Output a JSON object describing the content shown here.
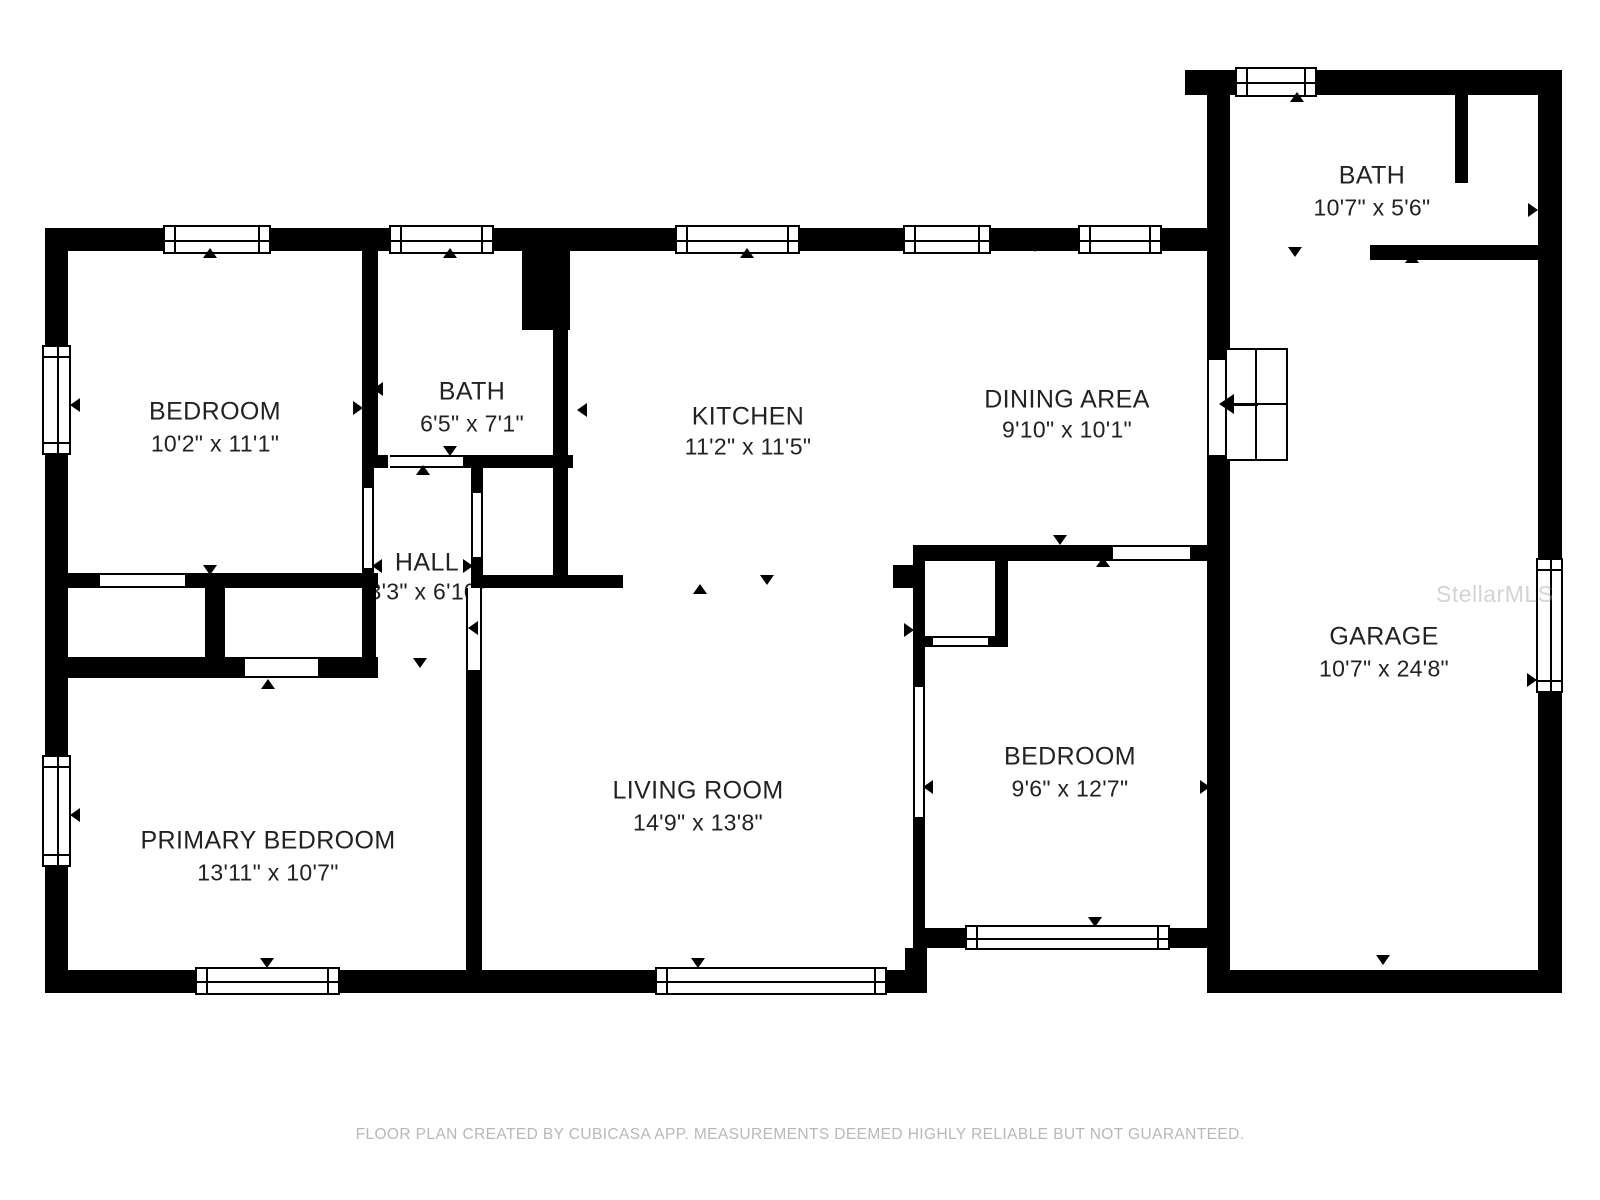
{
  "footer": {
    "disclaimer": "FLOOR PLAN CREATED BY CUBICASA APP. MEASUREMENTS DEEMED HIGHLY RELIABLE BUT NOT GUARANTEED."
  },
  "watermark": {
    "text": "StellarMLS"
  },
  "colors": {
    "wall": "#000000",
    "room_text": "#222222",
    "footer_text": "#b8b8b8",
    "watermark_text": "#9e9e9e",
    "background": "#ffffff"
  },
  "rooms": [
    {
      "name": "BATH",
      "dims": "10'7\" x 5'6\"",
      "cx": 1372,
      "name_y": 176,
      "dims_y": 208
    },
    {
      "name": "BEDROOM",
      "dims": "10'2\" x 11'1\"",
      "cx": 215,
      "name_y": 412,
      "dims_y": 444
    },
    {
      "name": "BATH",
      "dims": "6'5\" x 7'1\"",
      "cx": 472,
      "name_y": 392,
      "dims_y": 424
    },
    {
      "name": "KITCHEN",
      "dims": "11'2\" x 11'5\"",
      "cx": 748,
      "name_y": 417,
      "dims_y": 447
    },
    {
      "name": "DINING AREA",
      "dims": "9'10\" x 10'1\"",
      "cx": 1067,
      "name_y": 400,
      "dims_y": 430
    },
    {
      "name": "HALL",
      "dims": "3'3\" x 6'10\"",
      "cx": 427,
      "name_y": 563,
      "dims_y": 592
    },
    {
      "name": "GARAGE",
      "dims": "10'7\" x 24'8\"",
      "cx": 1384,
      "name_y": 637,
      "dims_y": 669
    },
    {
      "name": "PRIMARY BEDROOM",
      "dims": "13'11\" x 10'7\"",
      "cx": 268,
      "name_y": 841,
      "dims_y": 873
    },
    {
      "name": "LIVING ROOM",
      "dims": "14'9\" x 13'8\"",
      "cx": 698,
      "name_y": 791,
      "dims_y": 823
    },
    {
      "name": "BEDROOM",
      "dims": "9'6\" x 12'7\"",
      "cx": 1070,
      "name_y": 757,
      "dims_y": 789
    }
  ],
  "plan": {
    "walls": [
      [
        45,
        228,
        1162,
        23
      ],
      [
        45,
        228,
        23,
        765
      ],
      [
        45,
        970,
        882,
        23
      ],
      [
        905,
        948,
        22,
        45
      ],
      [
        913,
        928,
        294,
        20
      ],
      [
        1185,
        70,
        377,
        25
      ],
      [
        1538,
        70,
        24,
        923
      ],
      [
        1207,
        970,
        355,
        23
      ],
      [
        1207,
        70,
        23,
        290
      ],
      [
        1207,
        455,
        23,
        538
      ],
      [
        362,
        251,
        16,
        216
      ],
      [
        362,
        455,
        26,
        13
      ],
      [
        362,
        468,
        12,
        20
      ],
      [
        362,
        568,
        12,
        20
      ],
      [
        463,
        455,
        110,
        13
      ],
      [
        522,
        245,
        48,
        85
      ],
      [
        553,
        330,
        15,
        245
      ],
      [
        471,
        468,
        12,
        25
      ],
      [
        471,
        557,
        12,
        18
      ],
      [
        472,
        575,
        151,
        13
      ],
      [
        45,
        573,
        55,
        15
      ],
      [
        185,
        573,
        193,
        15
      ],
      [
        205,
        588,
        20,
        69
      ],
      [
        45,
        657,
        200,
        21
      ],
      [
        318,
        657,
        60,
        21
      ],
      [
        362,
        588,
        14,
        84
      ],
      [
        471,
        558,
        12,
        30
      ],
      [
        466,
        670,
        16,
        302
      ],
      [
        913,
        545,
        200,
        16
      ],
      [
        1190,
        545,
        17,
        16
      ],
      [
        913,
        561,
        12,
        126
      ],
      [
        913,
        817,
        12,
        111
      ],
      [
        893,
        565,
        20,
        23
      ],
      [
        995,
        561,
        13,
        86
      ],
      [
        925,
        636,
        8,
        11
      ],
      [
        988,
        636,
        20,
        11
      ],
      [
        1455,
        95,
        13,
        88
      ],
      [
        1370,
        245,
        168,
        15
      ]
    ],
    "windows": [
      [
        163,
        225,
        108,
        29,
        "h"
      ],
      [
        389,
        225,
        105,
        29,
        "h"
      ],
      [
        675,
        225,
        125,
        29,
        "h"
      ],
      [
        903,
        225,
        88,
        29,
        "h"
      ],
      [
        1078,
        225,
        84,
        29,
        "h"
      ],
      [
        1235,
        67,
        82,
        30,
        "h"
      ],
      [
        42,
        345,
        29,
        110,
        "v"
      ],
      [
        42,
        755,
        29,
        112,
        "v"
      ],
      [
        195,
        967,
        145,
        28,
        "h"
      ],
      [
        655,
        967,
        232,
        28,
        "h"
      ],
      [
        965,
        925,
        205,
        25,
        "h"
      ],
      [
        1536,
        558,
        27,
        135,
        "v"
      ]
    ],
    "openings": [
      [
        362,
        488,
        12,
        80,
        "v"
      ],
      [
        390,
        455,
        73,
        13,
        "h"
      ],
      [
        471,
        493,
        12,
        64,
        "v"
      ],
      [
        100,
        573,
        85,
        15,
        "h"
      ],
      [
        245,
        657,
        73,
        21,
        "h"
      ],
      [
        466,
        588,
        16,
        82,
        "v"
      ],
      [
        913,
        687,
        12,
        130,
        "v"
      ],
      [
        933,
        636,
        55,
        11,
        "h"
      ],
      [
        1113,
        545,
        77,
        16,
        "h"
      ],
      [
        1207,
        360,
        23,
        95,
        "v"
      ]
    ],
    "arrows": [
      [
        210,
        253,
        "u"
      ],
      [
        450,
        253,
        "u"
      ],
      [
        747,
        253,
        "u"
      ],
      [
        1035,
        247,
        "d"
      ],
      [
        1297,
        97,
        "u"
      ],
      [
        1295,
        252,
        "d"
      ],
      [
        1412,
        258,
        "u"
      ],
      [
        1533,
        210,
        "r"
      ],
      [
        75,
        405,
        "l"
      ],
      [
        75,
        815,
        "l"
      ],
      [
        267,
        963,
        "d"
      ],
      [
        698,
        963,
        "d"
      ],
      [
        1095,
        922,
        "d"
      ],
      [
        1383,
        960,
        "d"
      ],
      [
        1532,
        680,
        "r"
      ],
      [
        378,
        389,
        "l"
      ],
      [
        358,
        408,
        "r"
      ],
      [
        560,
        389,
        "r"
      ],
      [
        582,
        410,
        "l"
      ],
      [
        450,
        451,
        "d"
      ],
      [
        423,
        470,
        "u"
      ],
      [
        210,
        570,
        "d"
      ],
      [
        268,
        684,
        "u"
      ],
      [
        420,
        663,
        "d"
      ],
      [
        377,
        566,
        "l"
      ],
      [
        468,
        566,
        "r"
      ],
      [
        473,
        628,
        "l"
      ],
      [
        475,
        837,
        "r"
      ],
      [
        767,
        580,
        "d"
      ],
      [
        700,
        589,
        "u"
      ],
      [
        1103,
        562,
        "u"
      ],
      [
        1060,
        540,
        "d"
      ],
      [
        909,
        630,
        "r"
      ],
      [
        928,
        787,
        "l"
      ],
      [
        1205,
        787,
        "r"
      ],
      [
        1222,
        212,
        "l"
      ]
    ],
    "cabinet": {
      "rect": [
        1225,
        348,
        63,
        113
      ],
      "vline_x": 30,
      "hline_y": 55,
      "shaft": [
        1230,
        403,
        28,
        3
      ],
      "arrow": [
        1226,
        404
      ]
    }
  }
}
